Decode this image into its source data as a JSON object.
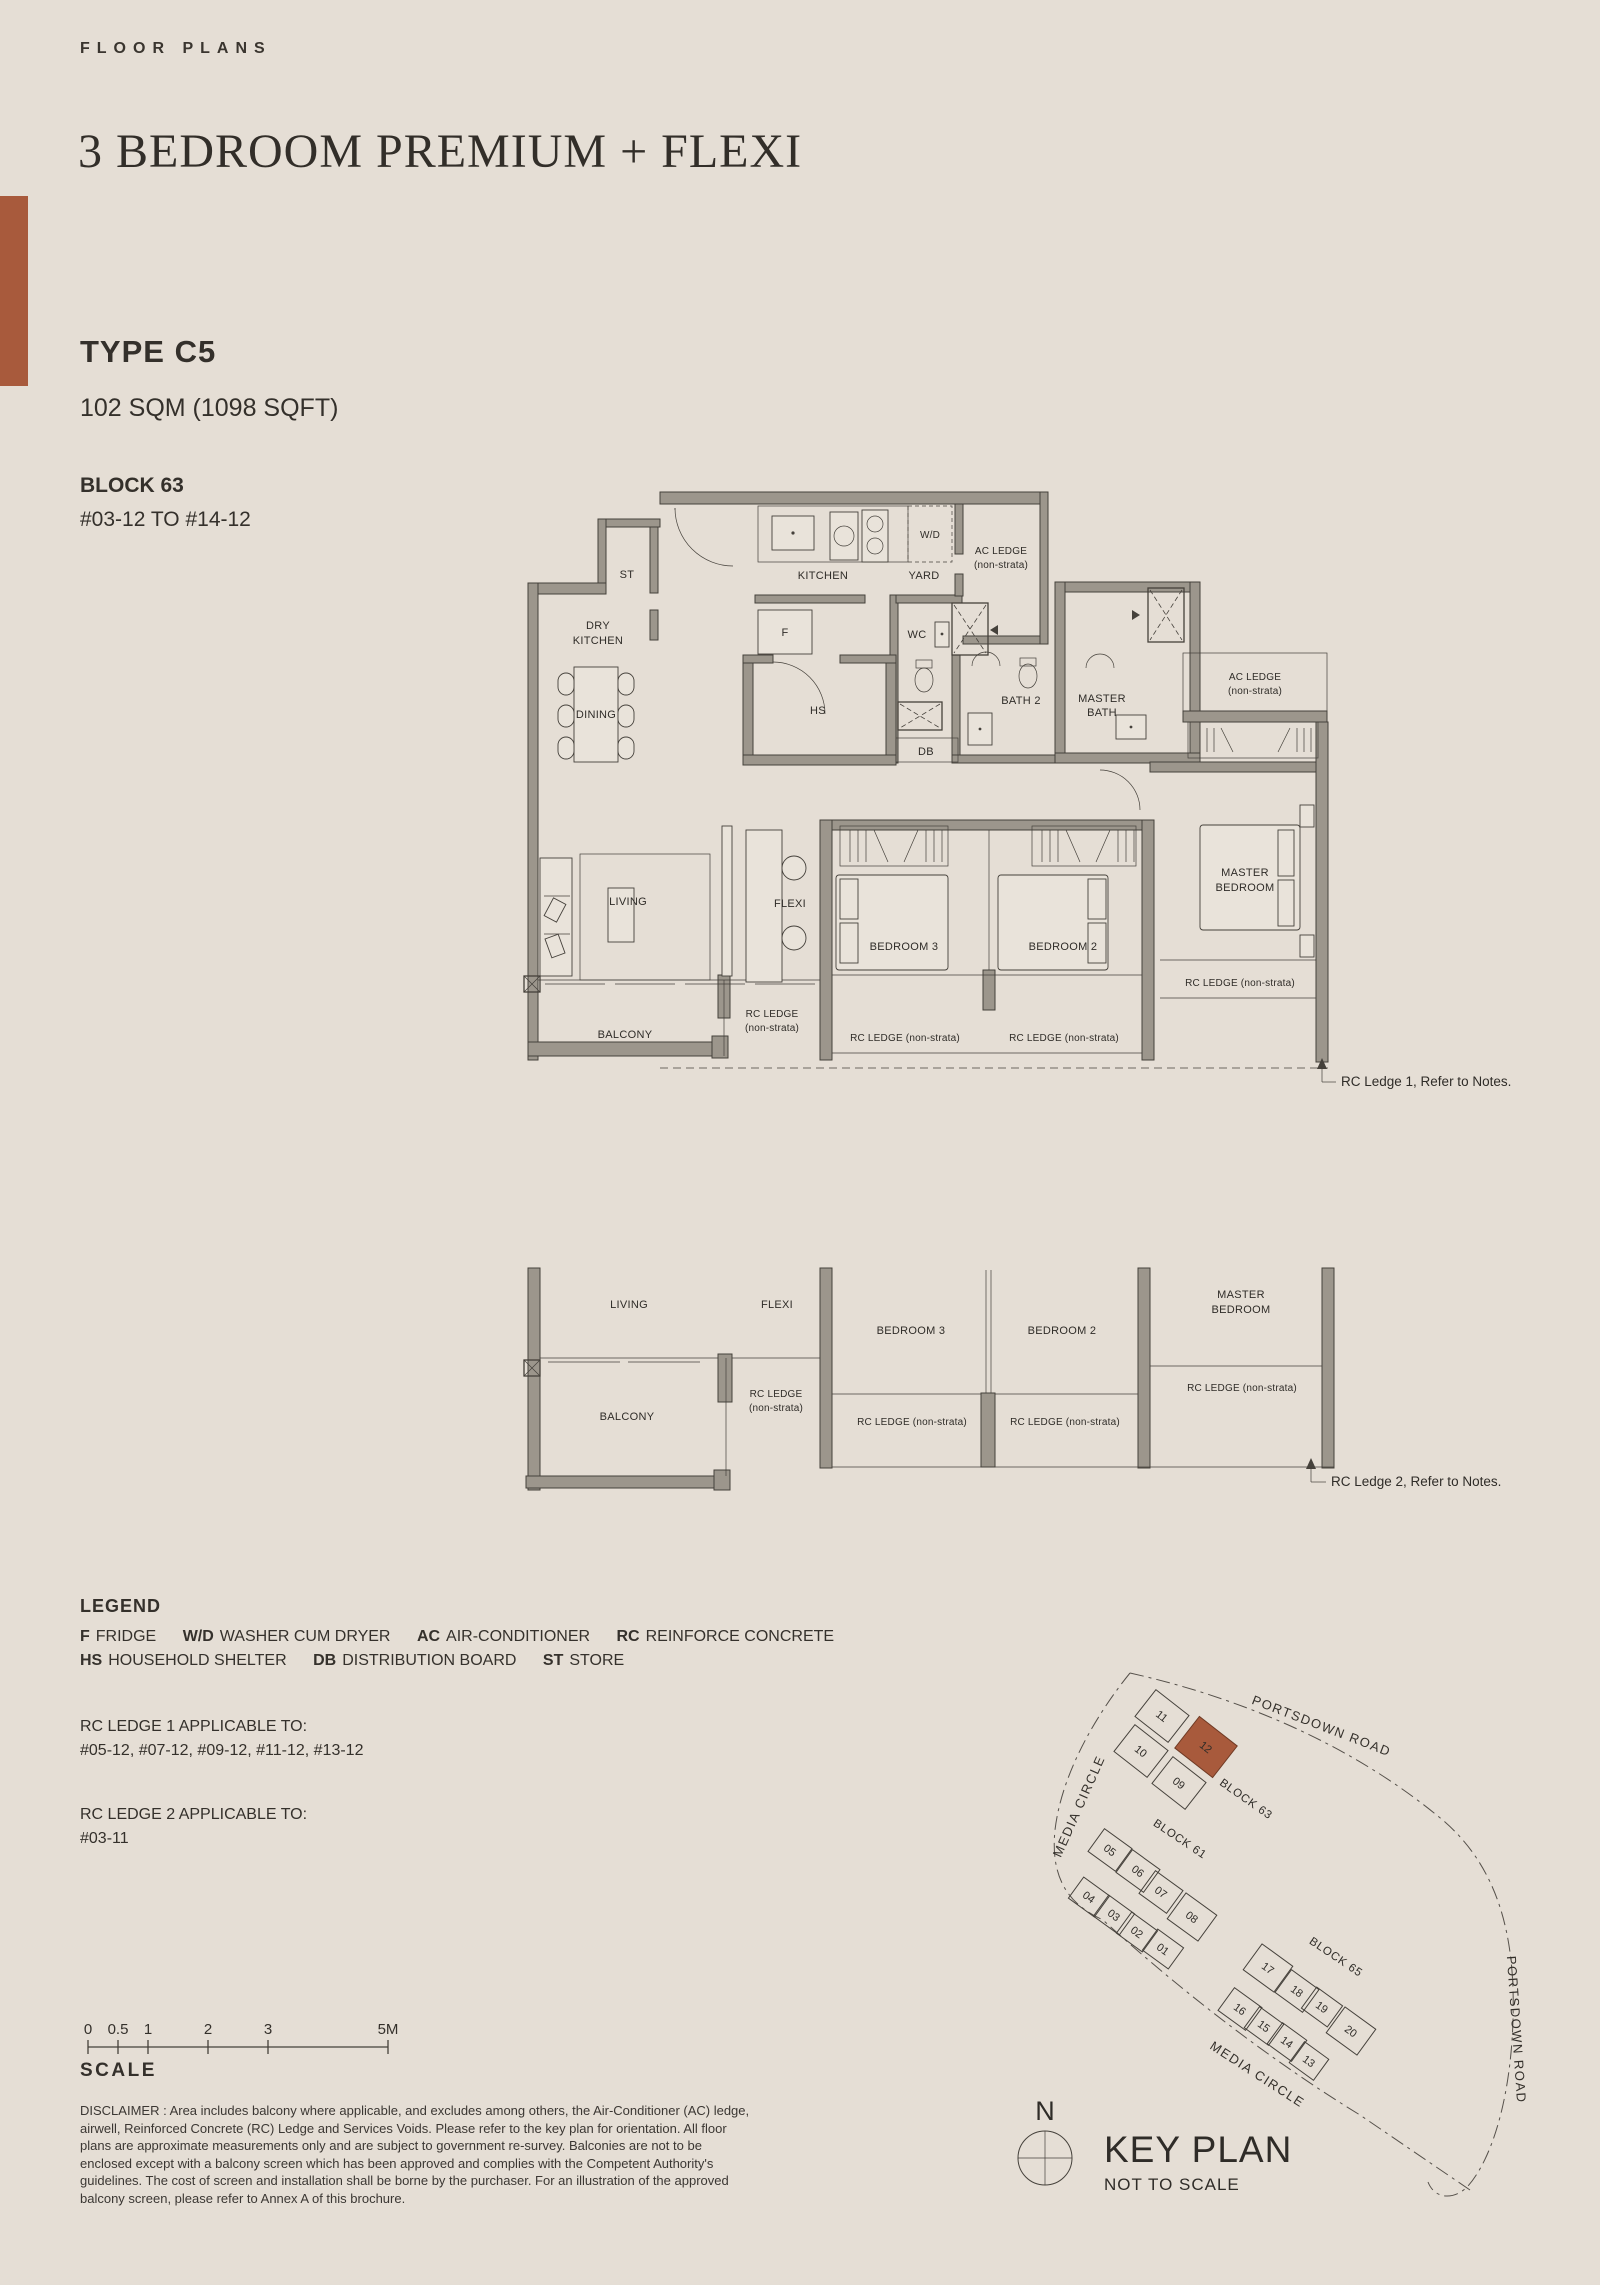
{
  "page": {
    "background": "#e5ded5",
    "accent": "#a85a3c"
  },
  "header": {
    "eyebrow": "FLOOR PLANS",
    "title": "3 BEDROOM PREMIUM + FLEXI"
  },
  "unit": {
    "type": "TYPE C5",
    "area": "102 SQM (1098 SQFT)",
    "block": "BLOCK 63",
    "stack": "#03-12 TO #14-12"
  },
  "plan": {
    "st": "ST",
    "kitchen": "KITCHEN",
    "yard": "YARD",
    "wd": "W/D",
    "ac_ledge": "AC LEDGE",
    "non_strata": "(non-strata)",
    "dry1": "DRY",
    "dry2": "KITCHEN",
    "dining": "DINING",
    "f": "F",
    "hs": "HS",
    "wc": "WC",
    "bath2": "BATH 2",
    "mbath1": "MASTER",
    "mbath2": "BATH",
    "db": "DB",
    "living": "LIVING",
    "flexi": "FLEXI",
    "bedroom3": "BEDROOM 3",
    "bedroom2": "BEDROOM 2",
    "master1": "MASTER",
    "master2": "BEDROOM",
    "balcony": "BALCONY",
    "rc_ledge": "RC LEDGE",
    "rc_ledge_full": "RC LEDGE (non-strata)"
  },
  "notes": {
    "rc1": "RC Ledge 1, Refer to Notes.",
    "rc2": "RC Ledge 2, Refer to Notes."
  },
  "legend": {
    "title": "LEGEND",
    "rows": [
      [
        {
          "abbr": "F",
          "desc": "FRIDGE"
        },
        {
          "abbr": "W/D",
          "desc": "WASHER CUM DRYER"
        },
        {
          "abbr": "AC",
          "desc": "AIR-CONDITIONER"
        },
        {
          "abbr": "RC",
          "desc": "REINFORCE CONCRETE"
        }
      ],
      [
        {
          "abbr": "HS",
          "desc": "HOUSEHOLD SHELTER"
        },
        {
          "abbr": "DB",
          "desc": "DISTRIBUTION BOARD"
        },
        {
          "abbr": "ST",
          "desc": "STORE"
        }
      ]
    ],
    "rc1_title": "RC LEDGE 1 APPLICABLE TO:",
    "rc1_units": "#05-12, #07-12, #09-12, #11-12, #13-12",
    "rc2_title": "RC LEDGE 2 APPLICABLE TO:",
    "rc2_units": "#03-11"
  },
  "scalebar": {
    "ticks": [
      "0",
      "0.5",
      "1",
      "2",
      "3",
      "5M"
    ],
    "label": "SCALE"
  },
  "disclaimer": "DISCLAIMER : Area includes balcony where applicable, and excludes among others, the Air-Conditioner (AC) ledge, airwell, Reinforced Concrete (RC) Ledge and Services Voids. Please refer to the key plan for orientation. All floor plans are approximate measurements only and are subject to government re-survey. Balconies are not to be enclosed except with a balcony screen which has been approved and complies with the Competent Authority's guidelines. The cost of screen and installation shall be borne by the purchaser. For an illustration of the approved balcony screen, please refer to Annex A of this brochure.",
  "keyplan": {
    "title": "KEY PLAN",
    "subtitle": "NOT TO SCALE",
    "north": "N",
    "roads": {
      "portsdown_top": "PORTSDOWN ROAD",
      "portsdown_right": "PORTSDOWN ROAD",
      "media_left": "MEDIA CIRCLE",
      "media_bottom": "MEDIA CIRCLE"
    },
    "blocks": {
      "b63": {
        "label": "BLOCK 63",
        "units": [
          "11",
          "10",
          "12",
          "09"
        ],
        "highlight": "12"
      },
      "b61": {
        "label": "BLOCK 61",
        "units": [
          "05",
          "06",
          "07",
          "08",
          "04",
          "03",
          "02",
          "01"
        ]
      },
      "b65": {
        "label": "BLOCK 65",
        "units": [
          "17",
          "18",
          "19",
          "20",
          "16",
          "15",
          "14",
          "13"
        ]
      }
    }
  }
}
